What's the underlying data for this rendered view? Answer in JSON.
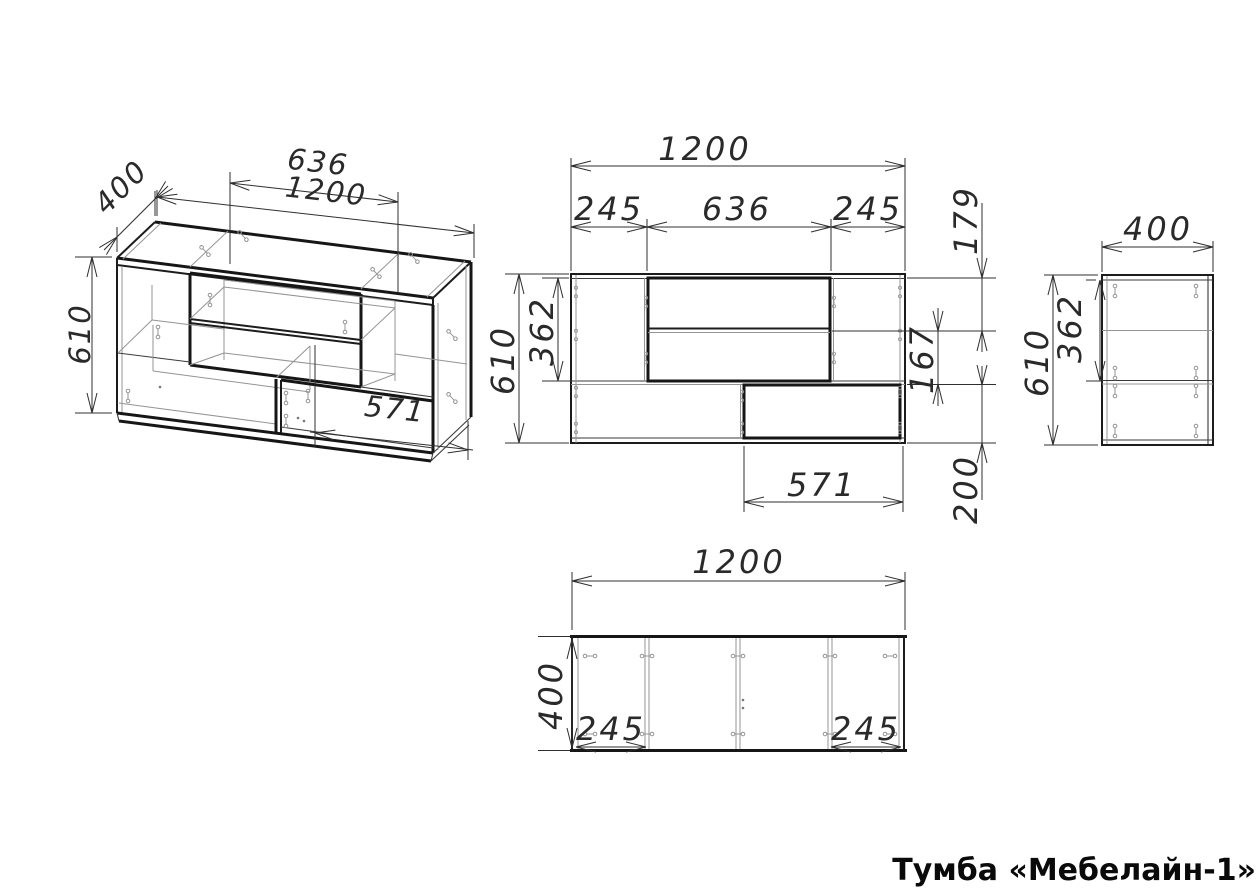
{
  "title": "Тумба «Мебелайн-1»",
  "views": {
    "isometric": {
      "dims": {
        "depth": "400",
        "middle_width": "636",
        "width": "1200",
        "height": "610",
        "door_width": "571"
      }
    },
    "front": {
      "dims": {
        "width": "1200",
        "left_section": "245",
        "middle_section": "636",
        "right_section": "245",
        "height": "610",
        "top_section": "362",
        "upper_compartment": "179",
        "lower_compartment": "167",
        "bottom_section": "200",
        "door_width": "571"
      }
    },
    "side": {
      "dims": {
        "depth": "400",
        "height": "610",
        "top_section": "362"
      }
    },
    "top": {
      "dims": {
        "width": "1200",
        "depth": "400",
        "left_section": "245",
        "right_section": "245"
      }
    }
  }
}
